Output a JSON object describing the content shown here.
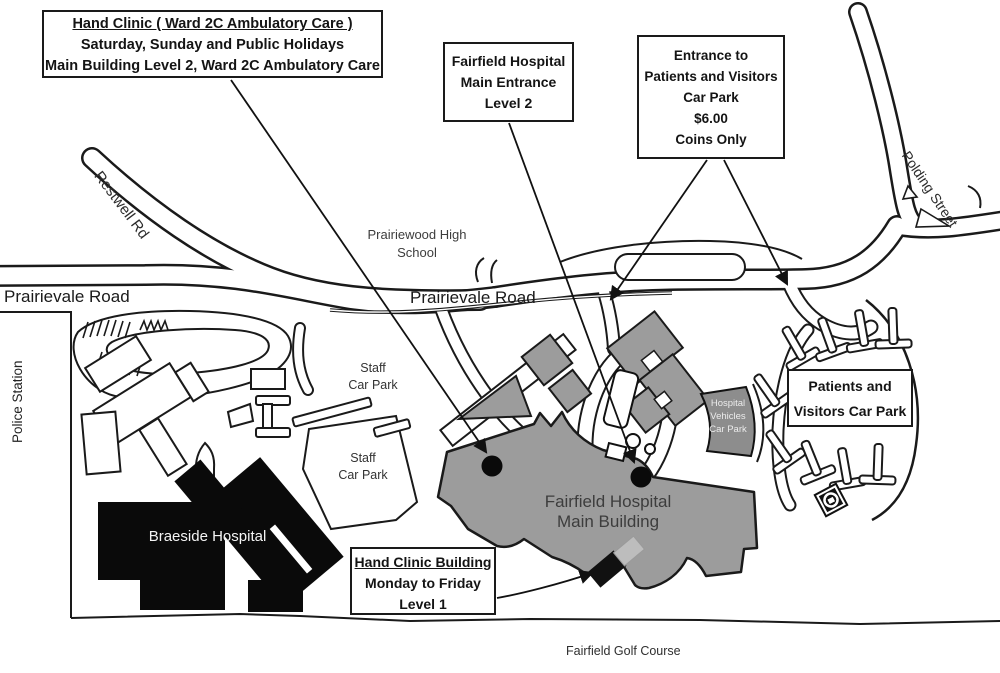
{
  "title": "Fairfield Hospital access map",
  "callouts": {
    "hand_clinic_weekend": {
      "lines": [
        "Hand Clinic ( Ward 2C Ambulatory Care )",
        "Saturday, Sunday and Public Holidays",
        "Main Building Level 2, Ward 2C Ambulatory Care"
      ]
    },
    "main_entrance": {
      "lines": [
        "Fairfield Hospital",
        "Main Entrance",
        "Level 2"
      ]
    },
    "carpark_entrance": {
      "lines": [
        "Entrance to",
        "Patients and Visitors",
        "Car Park",
        "$6.00",
        "Coins Only"
      ]
    },
    "visitors_carpark": {
      "lines": [
        "Patients and",
        "Visitors Car Park"
      ]
    },
    "hand_clinic_building": {
      "lines": [
        "Hand Clinic Building",
        "Monday to Friday",
        "Level 1"
      ]
    }
  },
  "map_labels": {
    "prairievale_road_west": "Prairievale Road",
    "prairievale_road_mid": "Prairievale Road",
    "restwell_rd": "Restwell Rd",
    "polding_street": "Polding Street",
    "police_station": "Police Station",
    "prairiewood_high_school": [
      "Prairiewood High",
      "School"
    ],
    "staff_car_park_upper": [
      "Staff",
      "Car Park"
    ],
    "staff_car_park_lower": [
      "Staff",
      "Car Park"
    ],
    "braeside_hospital": "Braeside Hospital",
    "fairfield_main_building": [
      "Fairfield Hospital",
      "Main Building"
    ],
    "hospital_vehicles_car_park": [
      "Hospital",
      "Vehicles",
      "Car Park"
    ],
    "fairfield_golf_course": "Fairfield Golf Course"
  },
  "colors": {
    "building_fill": "#9c9c9c",
    "vehicles_carpark_fill": "#8d8d8d",
    "hand_clinic_building_fill": "#111111",
    "hand_clinic_adjacent_fill": "#bdbdbd",
    "braeside_fill": "#0a0a0a",
    "outline": "#1a1a1a"
  }
}
